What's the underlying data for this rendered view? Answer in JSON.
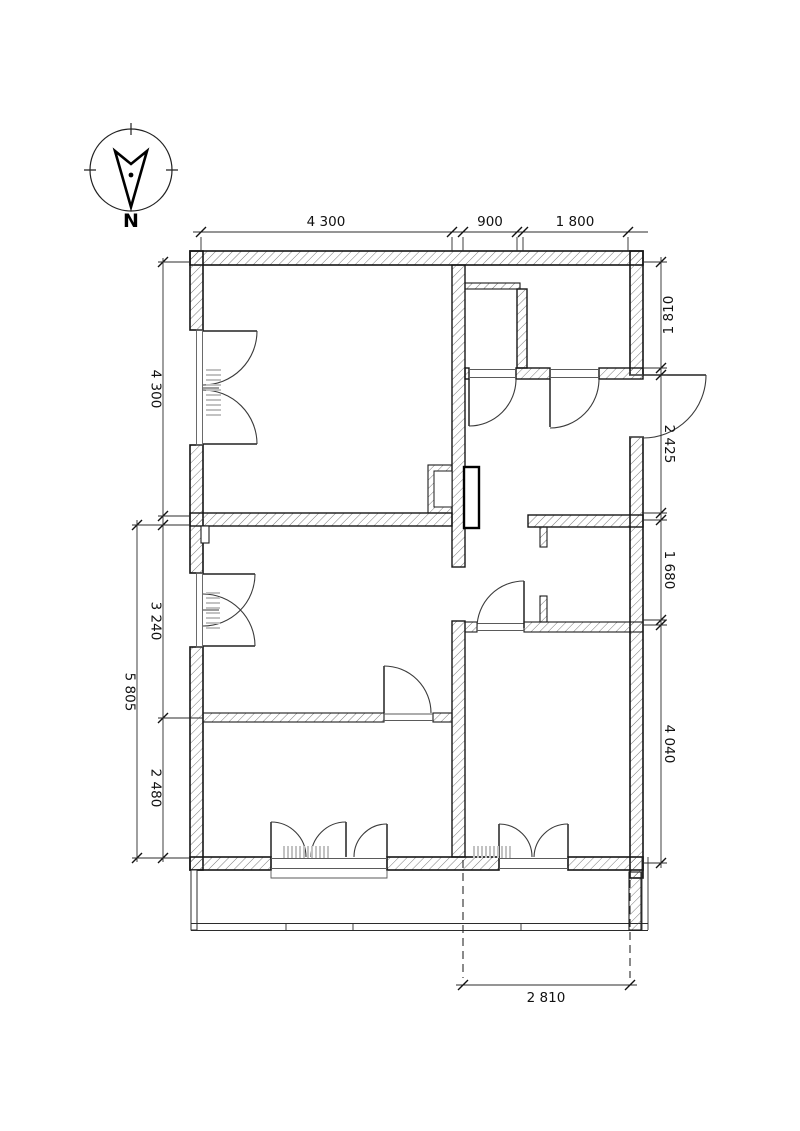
{
  "north_indicator": {
    "label": "N"
  },
  "dimensions": {
    "top": [
      "4 300",
      "900",
      "1 800"
    ],
    "left": [
      "4 300",
      "3 240",
      "2 480"
    ],
    "left_overall": "5 805",
    "right": [
      "1 810",
      "2 425",
      "1 680",
      "4 040"
    ],
    "bottom": "2 810"
  },
  "colors": {
    "background": "#ffffff",
    "wall_outline": "#161616",
    "hatch": "#4d4d4d",
    "dimension_line": "#2b2b2b",
    "radiator": "#c2c2c2"
  }
}
